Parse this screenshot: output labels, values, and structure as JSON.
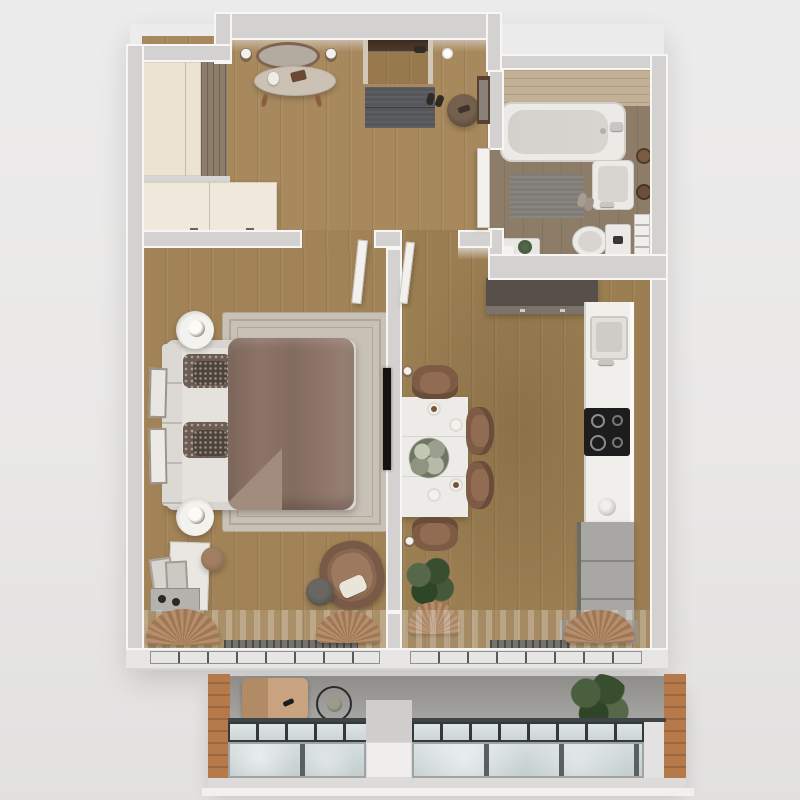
{
  "scene": {
    "kind": "floor-plan-3d-render",
    "view": "top-down",
    "text_visible": "none",
    "rooms": [
      {
        "id": "hallway",
        "floor": "wood"
      },
      {
        "id": "bathroom",
        "floor": "wood-tile"
      },
      {
        "id": "bedroom",
        "floor": "wood"
      },
      {
        "id": "kitchen-dining",
        "floor": "wood"
      },
      {
        "id": "balcony",
        "floor": "concrete"
      }
    ],
    "furniture": {
      "hallway": [
        "tall-wardrobe",
        "slatted-panel",
        "sideboard",
        "console-table",
        "oval-mirror",
        "wall-sconce-pair",
        "entry-door",
        "ceiling-lamp",
        "doormat",
        "shoes",
        "round-pouf",
        "leaning-mirror",
        "open-bathroom-door"
      ],
      "bathroom": [
        "bathtub",
        "wash-basin",
        "toilet",
        "bath-mat",
        "towel-rings",
        "towel-ladder",
        "side-table-with-plant",
        "slippers"
      ],
      "bedroom": [
        "double-bed",
        "headboard",
        "pillows",
        "duvet",
        "area-rug",
        "nightstand-with-lamp-x2",
        "wall-frames-x2",
        "wall-tv",
        "armchair",
        "knit-pouf",
        "bench",
        "leaning-mirrors",
        "stool",
        "shoe-tray",
        "curtain-drapes",
        "sheer-curtain",
        "floor-vent"
      ],
      "kitchen-dining": [
        "dark-wall-cabinet",
        "counter-run",
        "kitchen-sink",
        "induction-cooktop",
        "kettle",
        "drawer-unit",
        "dining-table",
        "dining-chairs-x4",
        "floral-centerpiece",
        "place-settings-x4",
        "wall-sconce-x2",
        "potted-plant-in-basket",
        "curtain-drape",
        "floor-mat",
        "sheer-curtain",
        "floor-vent"
      ],
      "balcony": [
        "lounge-chair",
        "round-side-table",
        "potted-plant",
        "glass-balustrade-upper",
        "glass-balustrade-lower",
        "wood-side-panel-left",
        "wood-side-panel-right",
        "center-pillar"
      ]
    },
    "openings": [
      "entry-door-recess-top",
      "bedroom-door-open",
      "kitchen-door-open",
      "bathroom-door-open",
      "window-wall-bedroom",
      "window-wall-kitchen"
    ]
  },
  "palette": {
    "bg-top": "#edecec",
    "bg-bottom": "#e2e1e0",
    "wall": "#d3d2d0",
    "wall-edge": "#f7f6f4",
    "wall-face": "#d2c8b9",
    "wood-hall": "#a8895d",
    "wood-bed": "#a18357",
    "wood-kitchen": "#9b7e52",
    "wood-entry": "#97794d",
    "bath-floor": "#8d7c68",
    "bath-wall-wood": "#c2b196",
    "fixture-white": "#eceae7",
    "fixture-inner": "#d8d5d0",
    "cream": "#ece3d3",
    "cream-light": "#f0e8da",
    "taupe-slat": "#8d7d6b",
    "greige": "#cbc2b5",
    "bronze": "#7d6450",
    "mirror-glass": "#b3aba0",
    "doormat": "#54565a",
    "dark-shoe": "#2e2a26",
    "pouf-brown": "#5e4b3c",
    "door-dark": "#4e3a2c",
    "rug": "#c8c1b5",
    "rug-border": "#b0a898",
    "headboard": "#dcd9d4",
    "sheet": "#e5e2dd",
    "duvet": "#8c7366",
    "duvet-light": "#a18c7e",
    "pillow-a": "#6b5d53",
    "pillow-b": "#4e423b",
    "armchair": "#8a6750",
    "armchair-light": "#9c7a60",
    "pouf-gray": "#56524d",
    "tv-black": "#141210",
    "table-white": "#edebe7",
    "chair-brown": "#7d5b44",
    "chair-light": "#916c52",
    "plant-green": "#44583a",
    "plant-light": "#55694a",
    "basket-tan": "#b68e6c",
    "basket-dark": "#9e7754",
    "counter": "#f1efec",
    "counter-edge": "#fbfaf8",
    "cooktop": "#1d1d1d",
    "steel": "#c7c6c4",
    "cabinet-gray": "#a9a7a4",
    "cabinet-dark": "#57504a",
    "cabinet-dark-face": "#7b736c",
    "radiator": "#75736e",
    "band-light": "#e7e6e4",
    "balcony-floor": "#a8a6a3",
    "balcony-floor-dark": "#8f8d8a",
    "wood-accent": "#b5794a",
    "glass": "#ccd6d5",
    "glass-light": "#dde5e4",
    "frame-dark": "#33383a",
    "frame-silver": "#9fa3a3"
  }
}
